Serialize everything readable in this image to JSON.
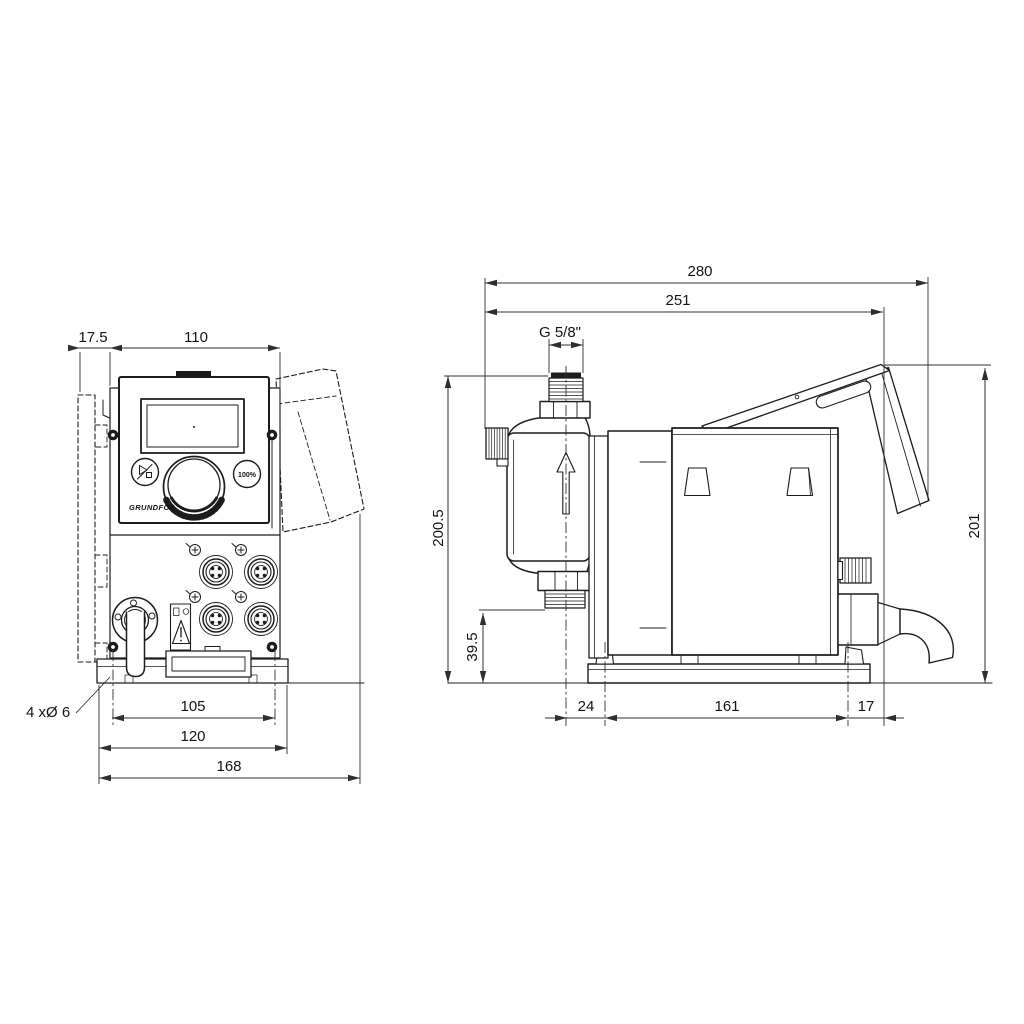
{
  "front_view": {
    "dims": {
      "bracket_offset": "17.5",
      "housing_width": "110",
      "hole_spacing": "105",
      "plate_width": "120",
      "overall_width": "168"
    },
    "holes_label": "4 xØ 6",
    "logo": "GRUNDFOS",
    "percent_button": "100%"
  },
  "side_view": {
    "dims": {
      "overall_depth": "280",
      "body_depth": "251",
      "thread": "G 5/8\"",
      "height_overall": "200.5",
      "valve_height": "39.5",
      "head_offset": "24",
      "foot_spacing": "161",
      "rear_offset": "17",
      "total_height": "201"
    }
  },
  "colors": {
    "line": "#1c1c1c",
    "dim": "#2f2f2f",
    "background": "#ffffff"
  }
}
